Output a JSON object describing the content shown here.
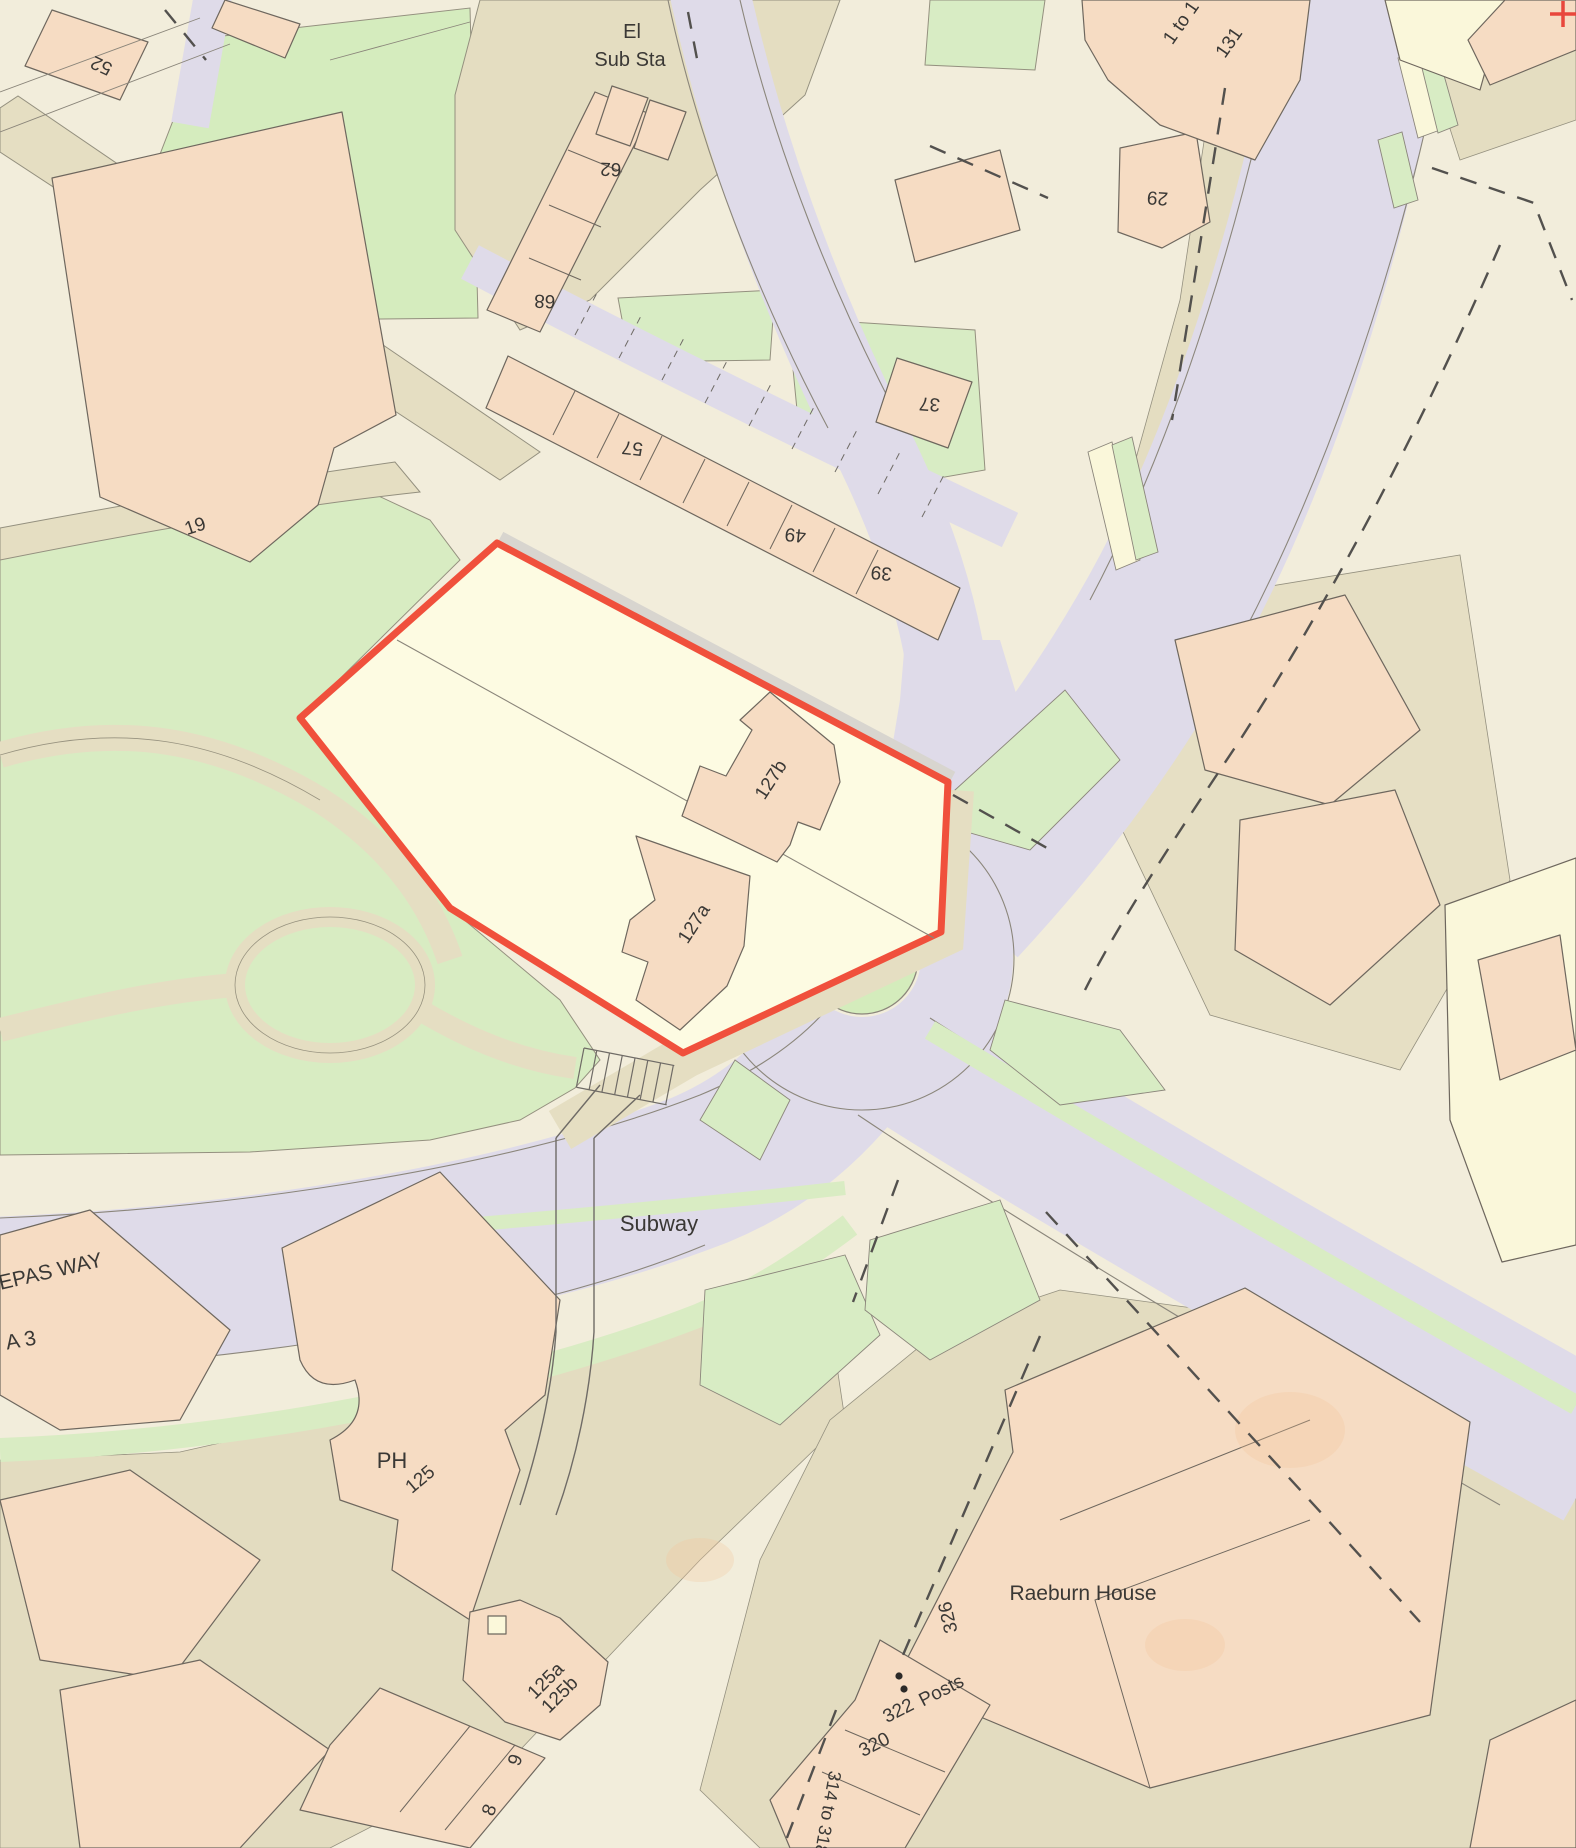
{
  "map": {
    "kind": "ordnance-survey-site-plan",
    "grid_cross_symbol": "+",
    "site": {
      "boundary_color": "#f0503c",
      "parcel_buildings": [
        "127a",
        "127b"
      ]
    },
    "colors": {
      "paper": "#f2eddb",
      "building_pink": "#f6dcc3",
      "grass_green": "#d8ecc2",
      "road_lavender": "#dfdbe9",
      "path_tan": "#e5dec2",
      "plot_cream": "#fdfbe2",
      "boundary_red": "#f0503c",
      "line_grey": "#6e675e"
    },
    "posts_marker": {
      "dot_count": 2
    },
    "labels": [
      {
        "id": "house-52",
        "text": "52"
      },
      {
        "id": "el-line1",
        "text": "El"
      },
      {
        "id": "el-line2",
        "text": "Sub Sta"
      },
      {
        "id": "house-62",
        "text": "62"
      },
      {
        "id": "house-68",
        "text": "68"
      },
      {
        "id": "house-57",
        "text": "57"
      },
      {
        "id": "house-49",
        "text": "49"
      },
      {
        "id": "house-39",
        "text": "39"
      },
      {
        "id": "house-37",
        "text": "37"
      },
      {
        "id": "house-29",
        "text": "29"
      },
      {
        "id": "flats-1-to-1",
        "text": "1 to 1"
      },
      {
        "id": "flats-131",
        "text": "131"
      },
      {
        "id": "house-19",
        "text": "19"
      },
      {
        "id": "house-127b",
        "text": "127b"
      },
      {
        "id": "house-127a",
        "text": "127a"
      },
      {
        "id": "subway",
        "text": "Subway"
      },
      {
        "id": "road-epas-way",
        "text": "EPAS WAY"
      },
      {
        "id": "road-a3",
        "text": "A 3"
      },
      {
        "id": "pub-ph",
        "text": "PH"
      },
      {
        "id": "house-125",
        "text": "125"
      },
      {
        "id": "house-125a",
        "text": "125a"
      },
      {
        "id": "house-125b",
        "text": "125b"
      },
      {
        "id": "house-9",
        "text": "9"
      },
      {
        "id": "house-8",
        "text": "8"
      },
      {
        "id": "raeburn-house",
        "text": "Raeburn House"
      },
      {
        "id": "house-326",
        "text": "326"
      },
      {
        "id": "posts",
        "text": "Posts"
      },
      {
        "id": "house-322",
        "text": "322"
      },
      {
        "id": "house-320",
        "text": "320"
      },
      {
        "id": "house-314-318",
        "text": "314 to 318"
      }
    ]
  }
}
